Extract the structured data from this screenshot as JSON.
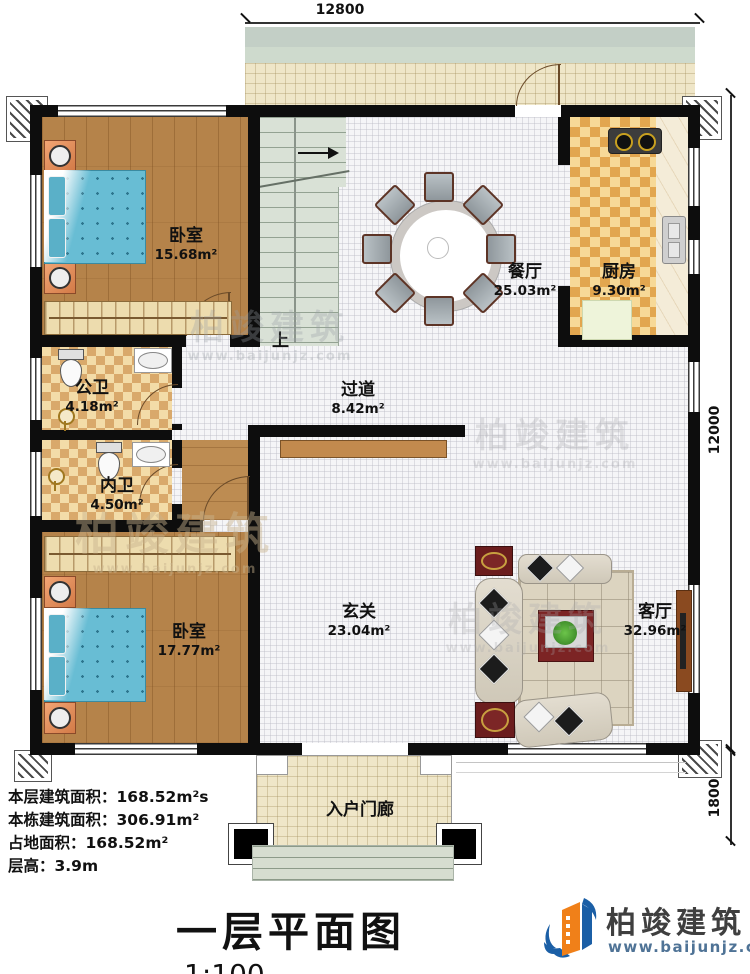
{
  "dimensions": {
    "top": "12800",
    "right": "12000",
    "bottom_right": "1800"
  },
  "rooms": {
    "bedroom1": {
      "name": "卧室",
      "area": "15.68m²"
    },
    "dining": {
      "name": "餐厅",
      "area": "25.03m²"
    },
    "kitchen": {
      "name": "厨房",
      "area": "9.30m²"
    },
    "bath_public": {
      "name": "公卫",
      "area": "4.18m²"
    },
    "bath_inner": {
      "name": "内卫",
      "area": "4.50m²"
    },
    "corridor": {
      "name": "过道",
      "area": "8.42m²"
    },
    "bedroom2": {
      "name": "卧室",
      "area": "17.77m²"
    },
    "foyer": {
      "name": "玄关",
      "area": "23.04m²"
    },
    "living": {
      "name": "客厅",
      "area": "32.96m²"
    },
    "porch": {
      "name": "入户门廊"
    }
  },
  "stairs": {
    "up_label": "上"
  },
  "info_lines": [
    "本层建筑面积：168.52m²s",
    "本栋建筑面积：306.91m²",
    "占地面积：168.52m²",
    "层高：3.9m"
  ],
  "title": {
    "text": "一层平面图",
    "scale": "1:100"
  },
  "brand": {
    "name": "柏竣建筑",
    "url": "www.baijunjz.com"
  },
  "watermark": {
    "name": "柏竣建筑",
    "url": "www.baijunjz.com"
  },
  "colors": {
    "wall": "#0d0d0d",
    "brand_orange": "#f08019",
    "brand_blue": "#1b5fa6",
    "url_blue": "#4f7396"
  }
}
